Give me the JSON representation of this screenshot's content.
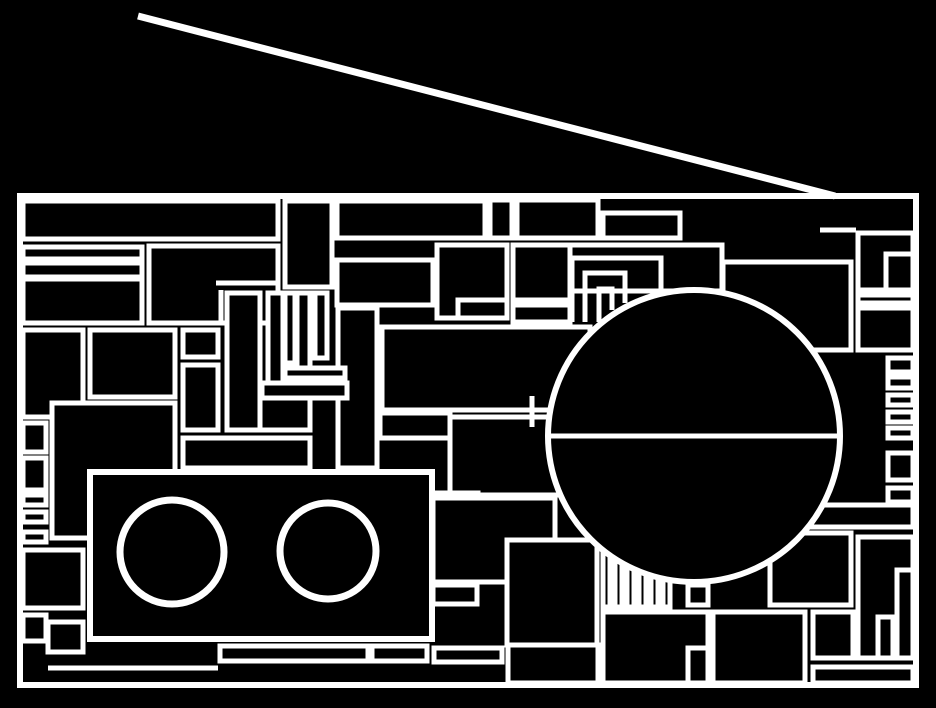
{
  "title": "Abstract line-art drawing of a radio boombox, white strokes on black",
  "canvas": {
    "width": 936,
    "height": 708,
    "background": "#000000",
    "line_color": "#ffffff",
    "default_stroke_width": 5
  },
  "antenna": {
    "x1": 138,
    "y1": 16,
    "x2": 835,
    "y2": 196,
    "stroke_width": 7
  },
  "frame": {
    "x": 20,
    "y": 196,
    "width": 896,
    "height": 489,
    "stroke_width": 6
  },
  "speaker": {
    "cx": 694,
    "cy": 436,
    "r": 146,
    "stroke_width": 6,
    "diameter_line": {
      "x1": 548,
      "y1": 436,
      "x2": 840,
      "y2": 436,
      "stroke_width": 5
    }
  },
  "cassette": {
    "x": 90,
    "y": 472,
    "width": 342,
    "height": 167,
    "stroke_width": 6,
    "reels": [
      {
        "cx": 172,
        "cy": 552,
        "r": 52,
        "stroke_width": 7
      },
      {
        "cx": 328,
        "cy": 551,
        "r": 48,
        "stroke_width": 7
      }
    ]
  },
  "panel_rects": [
    [
      23,
      201,
      255,
      38
    ],
    [
      23,
      247,
      119,
      12
    ],
    [
      23,
      263,
      119,
      14
    ],
    [
      23,
      279,
      119,
      44
    ],
    [
      149,
      246,
      129,
      77
    ],
    [
      285,
      201,
      47,
      86
    ],
    [
      337,
      201,
      148,
      37
    ],
    [
      490,
      200,
      22,
      38
    ],
    [
      517,
      200,
      81,
      38
    ],
    [
      603,
      213,
      77,
      25
    ],
    [
      565,
      245,
      157,
      46
    ],
    [
      437,
      245,
      70,
      73
    ],
    [
      458,
      300,
      49,
      18
    ],
    [
      513,
      245,
      57,
      55
    ],
    [
      513,
      305,
      57,
      17
    ],
    [
      337,
      260,
      96,
      45
    ],
    [
      338,
      308,
      39,
      160
    ],
    [
      723,
      262,
      128,
      88
    ],
    [
      858,
      233,
      55,
      57
    ],
    [
      886,
      254,
      27,
      36
    ],
    [
      858,
      295,
      55,
      8
    ],
    [
      858,
      308,
      55,
      42
    ],
    [
      888,
      358,
      25,
      14
    ],
    [
      888,
      377,
      25,
      11
    ],
    [
      888,
      395,
      25,
      10
    ],
    [
      888,
      412,
      25,
      10
    ],
    [
      888,
      428,
      25,
      10
    ],
    [
      888,
      453,
      25,
      27
    ],
    [
      888,
      488,
      25,
      14
    ],
    [
      811,
      505,
      102,
      22
    ],
    [
      770,
      533,
      81,
      72
    ],
    [
      858,
      537,
      55,
      121
    ],
    [
      878,
      617,
      15,
      41
    ],
    [
      897,
      570,
      16,
      88
    ],
    [
      813,
      612,
      40,
      46
    ],
    [
      813,
      667,
      100,
      16
    ],
    [
      713,
      612,
      92,
      71
    ],
    [
      603,
      612,
      105,
      71
    ],
    [
      688,
      648,
      20,
      35
    ],
    [
      688,
      585,
      20,
      20
    ],
    [
      23,
      330,
      60,
      87
    ],
    [
      90,
      330,
      85,
      67
    ],
    [
      183,
      330,
      35,
      27
    ],
    [
      183,
      365,
      35,
      65
    ],
    [
      227,
      293,
      33,
      137
    ],
    [
      268,
      293,
      15,
      95
    ],
    [
      285,
      293,
      10,
      70
    ],
    [
      297,
      293,
      13,
      82
    ],
    [
      315,
      293,
      12,
      65
    ],
    [
      285,
      368,
      60,
      10
    ],
    [
      262,
      383,
      85,
      15
    ],
    [
      260,
      398,
      50,
      32
    ],
    [
      183,
      438,
      127,
      30
    ],
    [
      52,
      403,
      123,
      135
    ],
    [
      23,
      423,
      23,
      29
    ],
    [
      23,
      458,
      23,
      32
    ],
    [
      23,
      495,
      23,
      10
    ],
    [
      23,
      512,
      23,
      10
    ],
    [
      23,
      532,
      23,
      10
    ],
    [
      23,
      550,
      60,
      58
    ],
    [
      23,
      615,
      23,
      26
    ],
    [
      48,
      622,
      35,
      30
    ],
    [
      382,
      327,
      208,
      83
    ],
    [
      380,
      413,
      70,
      25
    ],
    [
      450,
      417,
      110,
      78
    ],
    [
      433,
      493,
      45,
      89
    ],
    [
      433,
      498,
      122,
      84
    ],
    [
      507,
      540,
      90,
      105
    ],
    [
      433,
      585,
      44,
      19
    ],
    [
      434,
      648,
      68,
      14
    ],
    [
      603,
      540,
      7,
      67
    ],
    [
      615,
      540,
      7,
      67
    ],
    [
      627,
      540,
      7,
      67
    ],
    [
      639,
      540,
      7,
      67
    ],
    [
      651,
      540,
      7,
      67
    ],
    [
      663,
      540,
      7,
      67
    ],
    [
      220,
      646,
      148,
      15
    ],
    [
      372,
      646,
      55,
      15
    ],
    [
      508,
      645,
      90,
      38
    ]
  ],
  "corner_polylines": [
    [
      [
        572,
        322
      ],
      [
        572,
        258
      ],
      [
        661,
        258
      ],
      [
        661,
        293
      ]
    ],
    [
      [
        585,
        322
      ],
      [
        585,
        273
      ],
      [
        625,
        273
      ],
      [
        625,
        303
      ]
    ],
    [
      [
        599,
        322
      ],
      [
        599,
        289
      ],
      [
        612,
        289
      ],
      [
        612,
        310
      ]
    ]
  ],
  "detail_lines": [
    [
      820,
      230,
      856,
      230
    ],
    [
      48,
      668,
      218,
      668
    ],
    [
      216,
      283,
      278,
      283
    ],
    [
      221,
      290,
      221,
      323
    ],
    [
      532,
      396,
      532,
      427
    ]
  ]
}
